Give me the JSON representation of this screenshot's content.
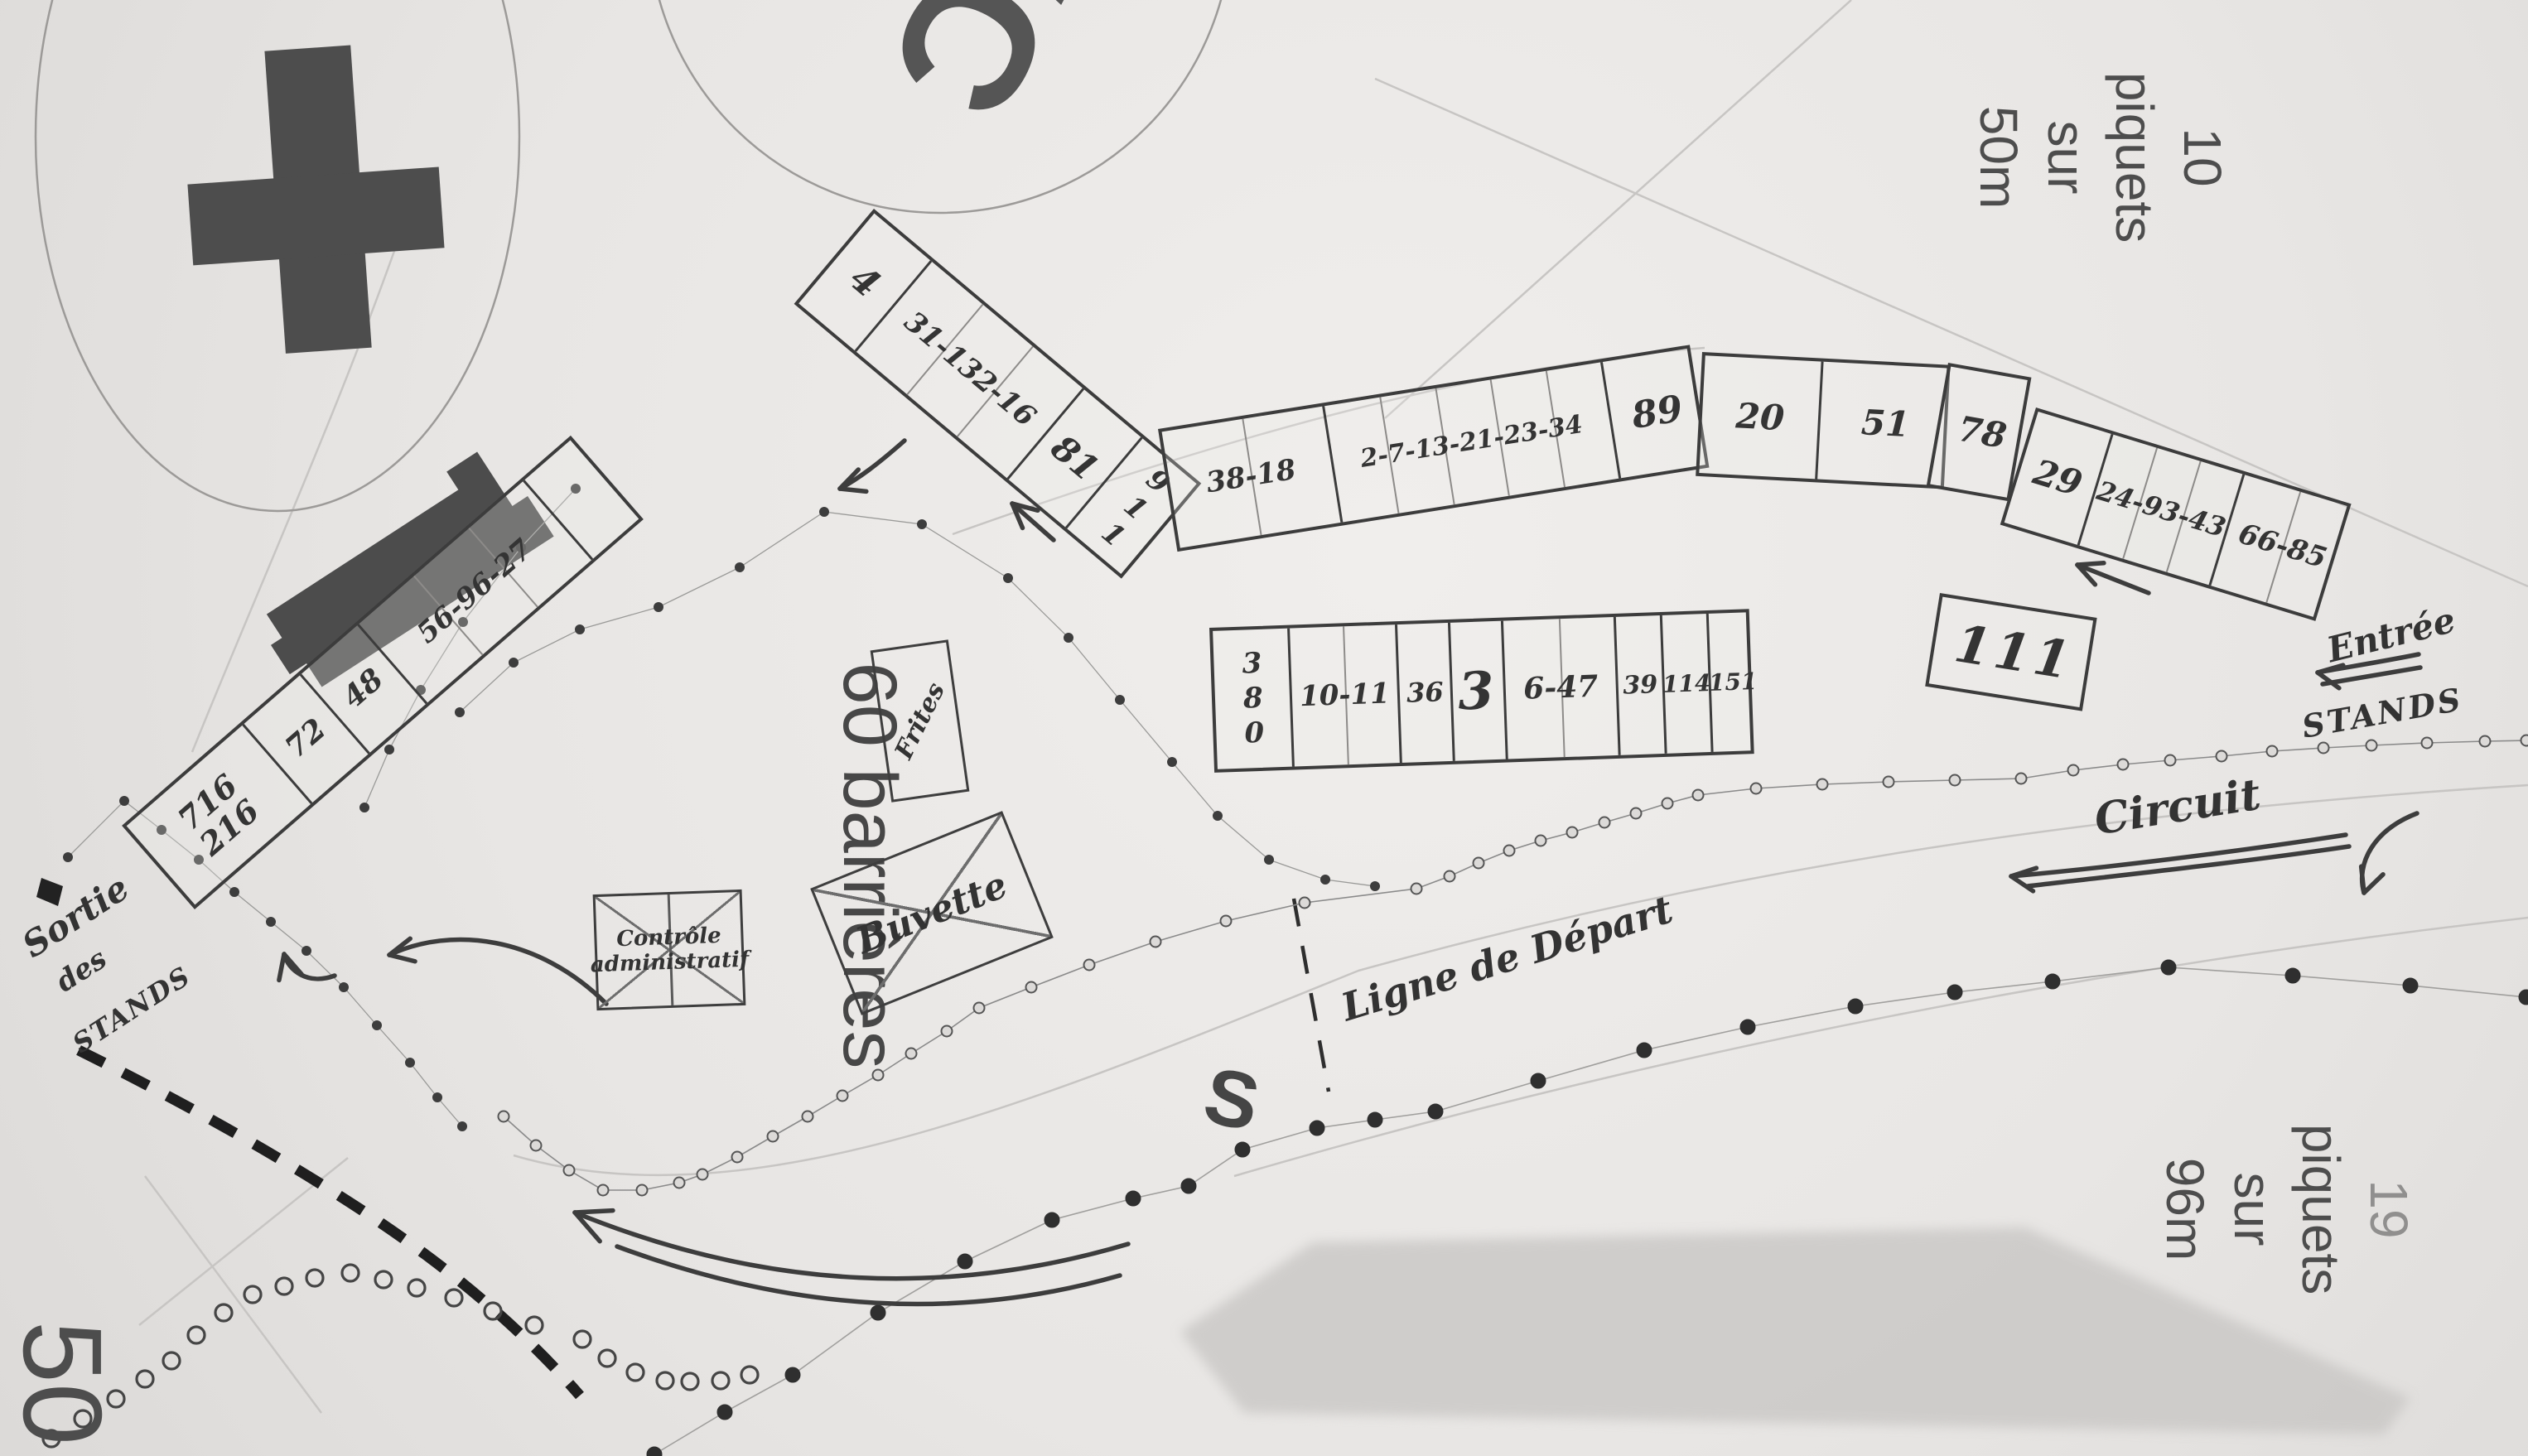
{
  "printed": {
    "wc": "WC",
    "note_top": {
      "l1": "10",
      "l2": "piquets",
      "l3": "sur",
      "l4": "50m"
    },
    "note_bottom": {
      "l1": "19",
      "l2": "piquets",
      "l3": "sur",
      "l4": "96m"
    },
    "barrieres": "60 barrières",
    "corner_number": "50",
    "stray_letter": "S"
  },
  "handwritten": {
    "frites": "Frites",
    "buvette": "Buvette",
    "controle_l1": "Contrôle",
    "controle_l2": "administratif",
    "ligne_depart": "Ligne de Départ",
    "circuit": "Circuit",
    "entree": "Entrée",
    "entree_stands": "STANDS",
    "sortie_l1": "Sortie",
    "sortie_l2": "des",
    "sortie_l3": "STANDS"
  },
  "strips": {
    "top_row_left": {
      "cells": [
        "4",
        "31-132-16",
        "81",
        "911"
      ]
    },
    "top_row_mid": {
      "cells": [
        "38-18",
        "2-7-13-21-23-34",
        "89"
      ]
    },
    "top_row_mid2": {
      "cells": [
        "20",
        "51"
      ]
    },
    "box_78": {
      "cells": [
        "78"
      ]
    },
    "top_row_right": {
      "cells": [
        "29",
        "24-93-43",
        "66-85"
      ]
    },
    "second_row": {
      "cells": [
        "380",
        "10-11",
        "36",
        "3",
        "6-47",
        "39",
        "114",
        "151"
      ]
    },
    "box_111": {
      "cells": [
        "111"
      ]
    },
    "left_row": {
      "cells": [
        "716\n216",
        "72",
        "48",
        "56-96-27",
        ""
      ]
    }
  },
  "icons": {
    "medical_cross": "medical-cross-icon",
    "building": "building-shape",
    "start_line": "dashed-start-line",
    "barrier": "striped-barrier"
  },
  "colors": {
    "paper": "#e9e7e4",
    "print_dark": "#4d4d4d",
    "print_faint": "#c7c5c3",
    "pencil": "#3b3b3b",
    "shade": "#c9c7c5"
  }
}
